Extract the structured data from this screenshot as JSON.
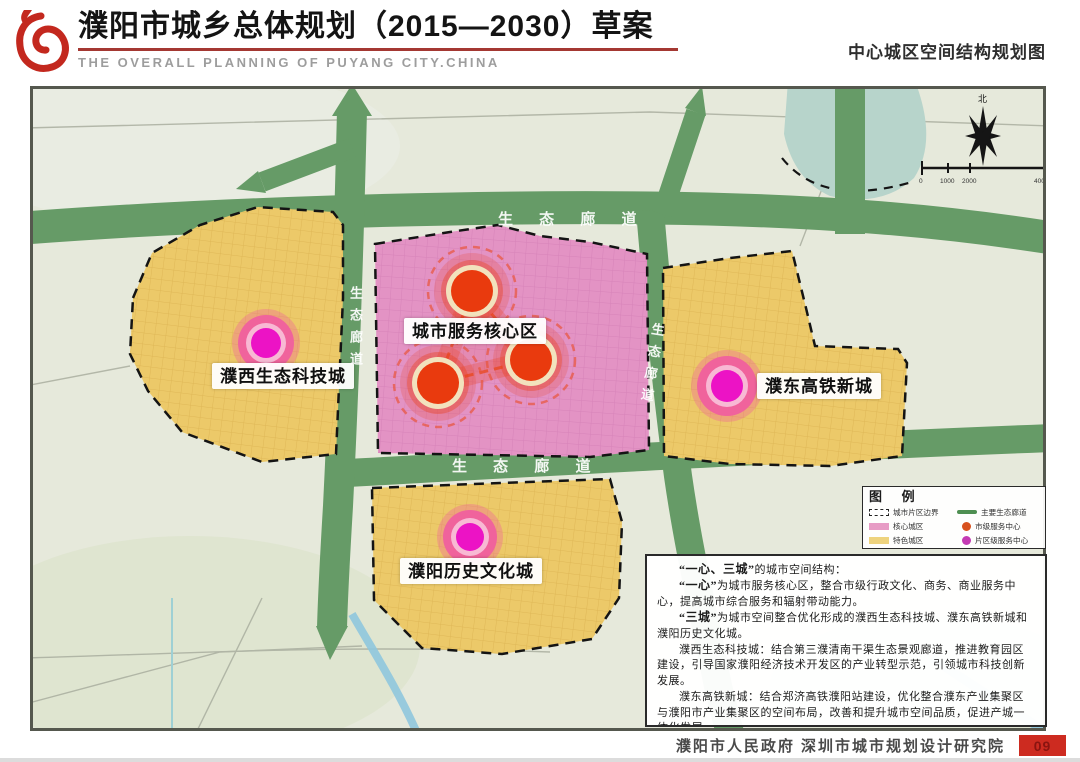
{
  "header": {
    "title": "濮阳市城乡总体规划（2015—2030）草案",
    "subtitle": "THE OVERALL PLANNING OF PUYANG CITY.CHINA",
    "right_title": "中心城区空间结构规划图"
  },
  "map": {
    "labels": {
      "core": "城市服务核心区",
      "west": "濮西生态科技城",
      "east": "濮东高铁新城",
      "south": "濮阳历史文化城"
    },
    "corridor_labels": {
      "top": "生 态 廊 道",
      "middle": "生 态 廊 道",
      "left_vertical": "生态廊道",
      "right_vertical": "生态廊道"
    },
    "compass_north": "北",
    "scale_ticks": [
      "0",
      "1000",
      "2000",
      "4000"
    ]
  },
  "legend": {
    "title": "图  例",
    "items": [
      {
        "label": "城市片区边界"
      },
      {
        "label": "主要生态廊道"
      },
      {
        "label": "核心城区"
      },
      {
        "label": "市级服务中心"
      },
      {
        "label": "特色城区"
      },
      {
        "label": "片区级服务中心"
      }
    ]
  },
  "description": {
    "paragraphs": [
      {
        "lead": "“一心、三城”",
        "rest": "的城市空间结构："
      },
      {
        "lead": "“一心”",
        "rest": "为城市服务核心区，整合市级行政文化、商务、商业服务中心，提高城市综合服务和辐射带动能力。"
      },
      {
        "lead": "“三城”",
        "rest": "为城市空间整合优化形成的濮西生态科技城、濮东高铁新城和濮阳历史文化城。"
      },
      {
        "lead": "",
        "rest": "濮西生态科技城：结合第三濮清南干渠生态景观廊道，推进教育园区建设，引导国家濮阳经济技术开发区的产业转型示范，引领城市科技创新发展。"
      },
      {
        "lead": "",
        "rest": "濮东高铁新城：结合郑济高铁濮阳站建设，优化整合濮东产业集聚区与濮阳市产业集聚区的空间布局，改善和提升城市空间品质，促进产城一体化发展。"
      },
      {
        "lead": "",
        "rest": "濮阳历史文化城：强调历史文化资源的保护和　　　　形成富有特色与活力的宜居城区。"
      }
    ]
  },
  "footer": {
    "credits": "濮阳市人民政府  深圳市城市规划设计研究院",
    "page_number": "09"
  },
  "colors": {
    "accent_red": "#c3281e",
    "corridor_green": "#669b67",
    "core_pink": "#e393c4",
    "district_yellow": "#ecc969",
    "node_red": "#e93a0e",
    "node_magenta": "#ec13c5",
    "badge_red": "#cd2b20"
  }
}
